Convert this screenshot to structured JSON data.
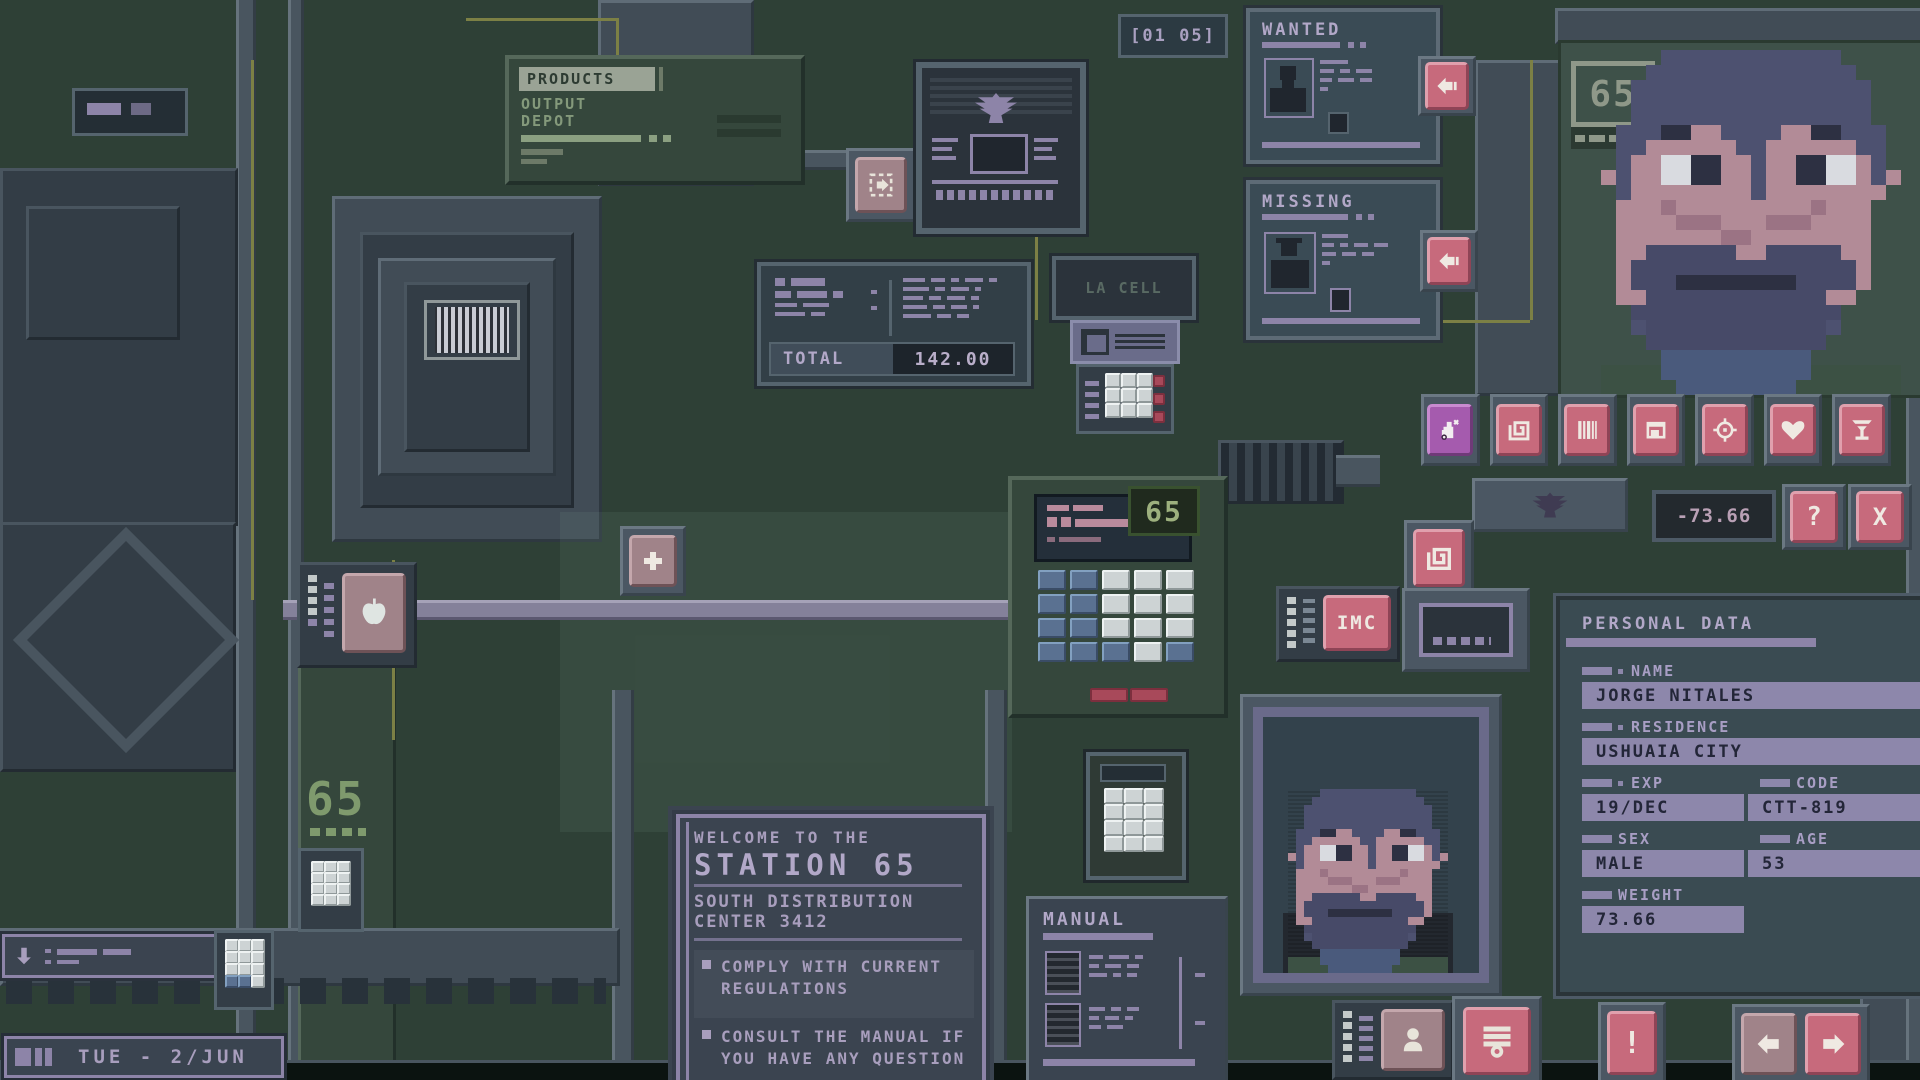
{
  "colors": {
    "accent_pink": "#c76a7c",
    "accent_pink_light": "#e0a0ad",
    "accent_purple": "#a55bae",
    "text_lavender": "#b2a8c8",
    "text_green": "#84997b",
    "lcd_green": "#9db07e",
    "screen_blue": "#3a4b55",
    "panel_green": "#3d5747",
    "steel": "#5d6b76"
  },
  "header": {
    "products_panel": {
      "title": "PRODUCTS",
      "line1": "OUTPUT",
      "line2": "DEPOT"
    },
    "page_counter": "[01 05]",
    "wanted_poster": {
      "title": "WANTED"
    },
    "missing_poster": {
      "title": "MISSING"
    }
  },
  "station": {
    "graffiti": "65"
  },
  "portrait_panel": {
    "label": "65"
  },
  "register": {
    "lcd": "65",
    "total_label": "TOTAL",
    "total_value": "142.00"
  },
  "cell_device": {
    "display": "LA CELL"
  },
  "toolbar": {
    "icons": [
      {
        "name": "soap-ban-icon"
      },
      {
        "name": "spiral-icon"
      },
      {
        "name": "barcode-icon"
      },
      {
        "name": "crate-icon"
      },
      {
        "name": "target-icon"
      },
      {
        "name": "heart-icon"
      },
      {
        "name": "cocktail-icon"
      }
    ]
  },
  "hud": {
    "balance": "-73.66",
    "help_label": "?",
    "close_label": "X",
    "alert_label": "!"
  },
  "imc_button_label": "IMC",
  "personal_data": {
    "title": "PERSONAL DATA",
    "fields": {
      "name": {
        "label": "NAME",
        "value": "JORGE NITALES"
      },
      "residence": {
        "label": "RESIDENCE",
        "value": "USHUAIA CITY"
      },
      "exp": {
        "label": "EXP",
        "value": "19/DEC"
      },
      "code": {
        "label": "CODE",
        "value": "CTT-819"
      },
      "sex": {
        "label": "SEX",
        "value": "MALE"
      },
      "age": {
        "label": "AGE",
        "value": "53"
      },
      "weight": {
        "label": "WEIGHT",
        "value": "73.66"
      }
    }
  },
  "welcome_sign": {
    "intro": "WELCOME TO THE",
    "title": "STATION 65",
    "subtitle1": "SOUTH DISTRIBUTION",
    "subtitle2": "CENTER 3412",
    "rules": [
      "COMPLY WITH CURRENT REGULATIONS",
      "CONSULT THE MANUAL IF YOU HAVE ANY QUESTION"
    ]
  },
  "manual_panel": {
    "title": "MANUAL"
  },
  "status_bar": {
    "date": "TUE - 2/JUN"
  }
}
